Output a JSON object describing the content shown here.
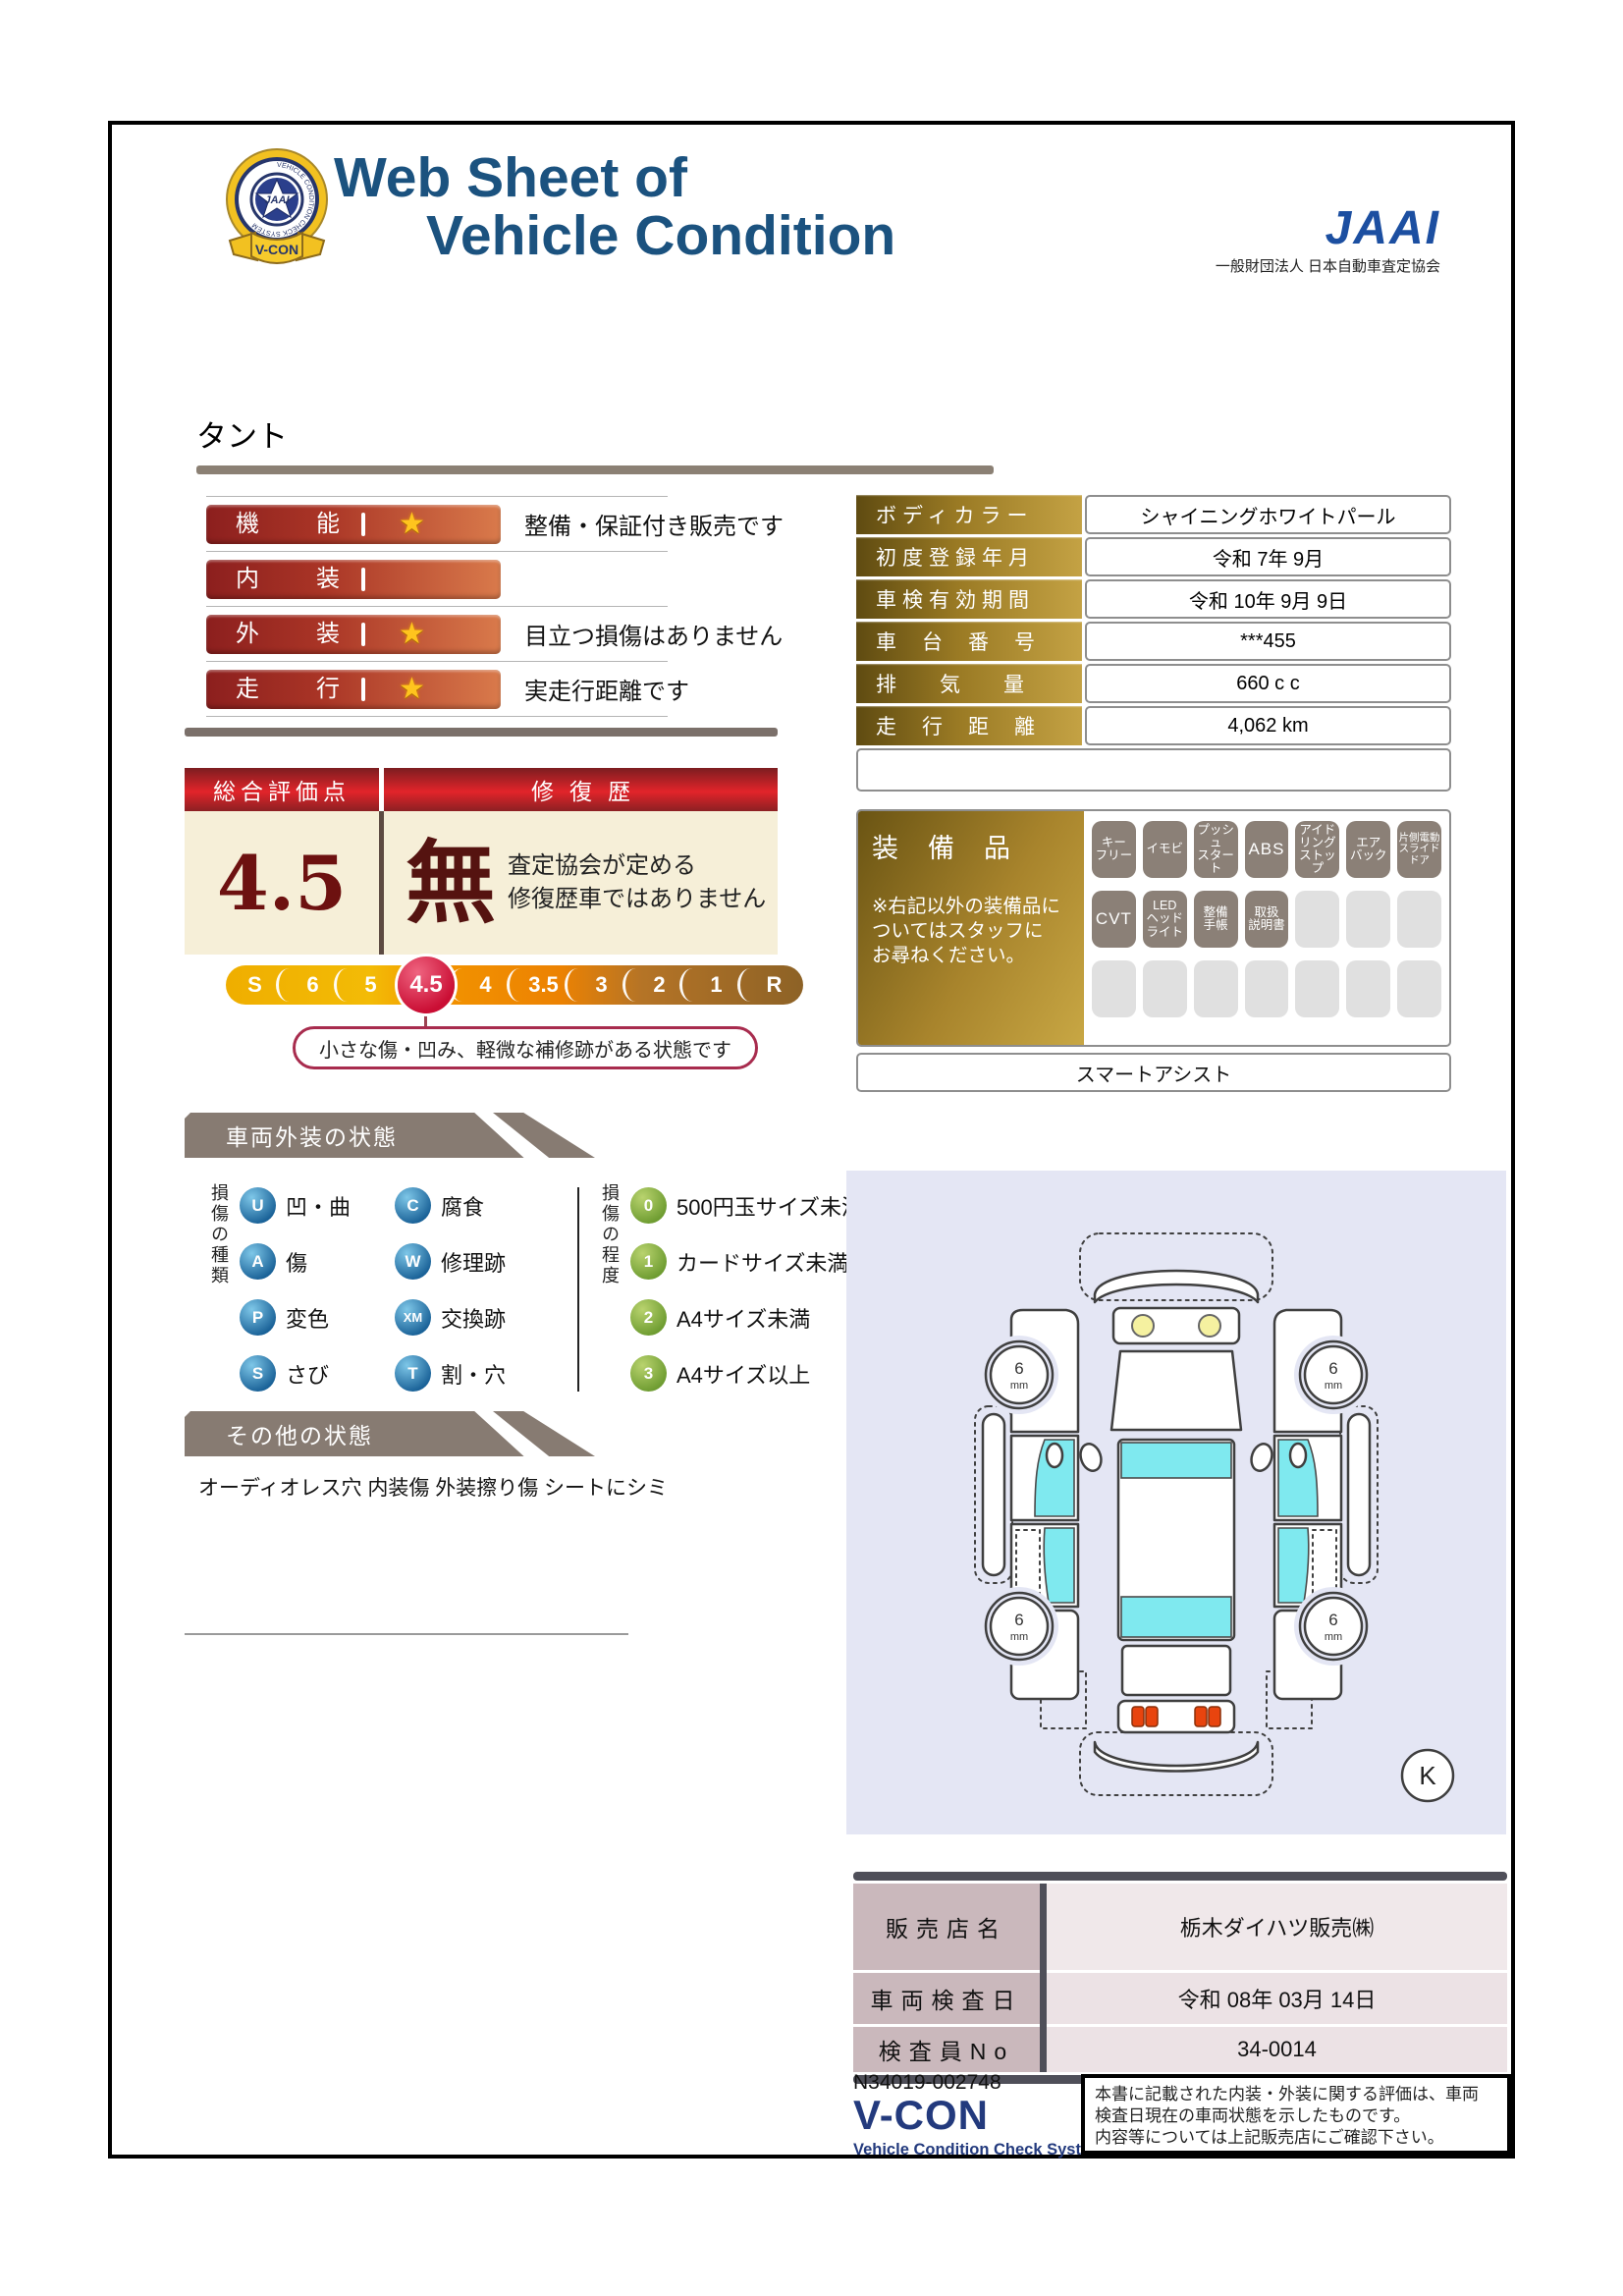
{
  "header": {
    "title_line1": "Web Sheet of",
    "title_line2": "Vehicle Condition",
    "jaai_logo": "JAAI",
    "jaai_subtitle": "一般財団法人 日本自動車査定協会",
    "badge_ring_text": "VEHICLE CONDITION CHECK SYSTEM",
    "badge_center_text": "JAAI",
    "badge_ribbon_text": "V-CON"
  },
  "vehicle_name": "タント",
  "ratings": {
    "rows": [
      {
        "label": "機能",
        "star": "★",
        "note": "整備・保証付き販売です"
      },
      {
        "label": "内装",
        "star": "",
        "note": ""
      },
      {
        "label": "外装",
        "star": "★",
        "note": "目立つ損傷はありません"
      },
      {
        "label": "走行",
        "star": "★",
        "note": "実走行距離です"
      }
    ]
  },
  "overall": {
    "header_left": "総合評価点",
    "header_right": "修復歴",
    "score": "4.5",
    "repair_mark": "無",
    "repair_note": "査定協会が定める\n修復歴車ではありません",
    "scale": [
      "S",
      "6",
      "5",
      "4.5",
      "4",
      "3.5",
      "3",
      "2",
      "1",
      "R"
    ],
    "selected_grade": "4.5",
    "callout": "小さな傷・凹み、軽微な補修跡がある状態です"
  },
  "spec_table": {
    "rows": [
      {
        "label": "ボディカラー",
        "value": "シャイニングホワイトパール"
      },
      {
        "label": "初度登録年月",
        "value": "令和 7年 9月"
      },
      {
        "label": "車検有効期間",
        "value": "令和 10年 9月 9日"
      },
      {
        "label": "車台番号",
        "value": "***455"
      },
      {
        "label": "排気量",
        "value": "660 c c"
      },
      {
        "label": "走行距離",
        "value": "4,062 km"
      }
    ]
  },
  "equipment": {
    "title": "装備品",
    "note": "※右記以外の装備品に\nついてはスタッフに\nお尋ねください。",
    "badges": [
      "キー\nフリー",
      "イモビ",
      "プッシュ\nスタート",
      "ABS",
      "アイド\nリング\nストップ",
      "エア\nバック",
      "片側電動\nスライド\nドア",
      "CVT",
      "LED\nヘッド\nライト",
      "整備\n手帳",
      "取扱\n説明書"
    ],
    "extra_row": "スマートアシスト"
  },
  "exterior_section": {
    "title": "車両外装の状態",
    "types_title": "損傷の種類",
    "types": [
      {
        "code": "U",
        "label": "凹・曲"
      },
      {
        "code": "C",
        "label": "腐食"
      },
      {
        "code": "A",
        "label": "傷"
      },
      {
        "code": "W",
        "label": "修理跡"
      },
      {
        "code": "P",
        "label": "変色"
      },
      {
        "code": "XM",
        "label": "交換跡"
      },
      {
        "code": "S",
        "label": "さび"
      },
      {
        "code": "T",
        "label": "割・穴"
      }
    ],
    "degrees_title": "損傷の程度",
    "degrees": [
      {
        "code": "0",
        "label": "500円玉サイズ未満"
      },
      {
        "code": "1",
        "label": "カードサイズ未満"
      },
      {
        "code": "2",
        "label": "A4サイズ未満"
      },
      {
        "code": "3",
        "label": "A4サイズ以上"
      }
    ]
  },
  "other_section": {
    "title": "その他の状態",
    "text": "オーディオレス穴 内装傷 外装擦り傷 シートにシミ"
  },
  "diagram": {
    "tires": [
      {
        "position": "front-left",
        "depth": "6"
      },
      {
        "position": "front-right",
        "depth": "6"
      },
      {
        "position": "rear-left",
        "depth": "6"
      },
      {
        "position": "rear-right",
        "depth": "6"
      }
    ],
    "tire_unit": "mm",
    "grade_mark": "K"
  },
  "dealer_table": {
    "rows": [
      {
        "label": "販売店名",
        "value": "栃木ダイハツ販売㈱"
      },
      {
        "label": "車両検査日",
        "value": "令和 08年 03月 14日"
      },
      {
        "label": "検査員No",
        "value": "34-0014"
      }
    ]
  },
  "footer": {
    "serial": "N34019-002748",
    "vcon_logo": "V-CON",
    "vcon_subtitle": "Vehicle Condition Check System",
    "note": "本書に記載された内装・外装に関する評価は、車両\n検査日現在の車両状態を示したものです。\n内容等については上記販売店にご確認下さい。"
  },
  "colors": {
    "title_blue": "#1b527f",
    "jaai_blue": "#1c4fa1",
    "rating_bar_red": "#9c2420",
    "gold_label": "#a8842c",
    "overall_header_red": "#d21e24",
    "selected_grade_red": "#ca0e34",
    "section_tab_gray": "#877b72",
    "type_badge_blue": "#1a6298",
    "degree_badge_green": "#6e9c31",
    "glass_cyan": "#7fe9ef",
    "diagram_bg": "#e4e6f4"
  }
}
